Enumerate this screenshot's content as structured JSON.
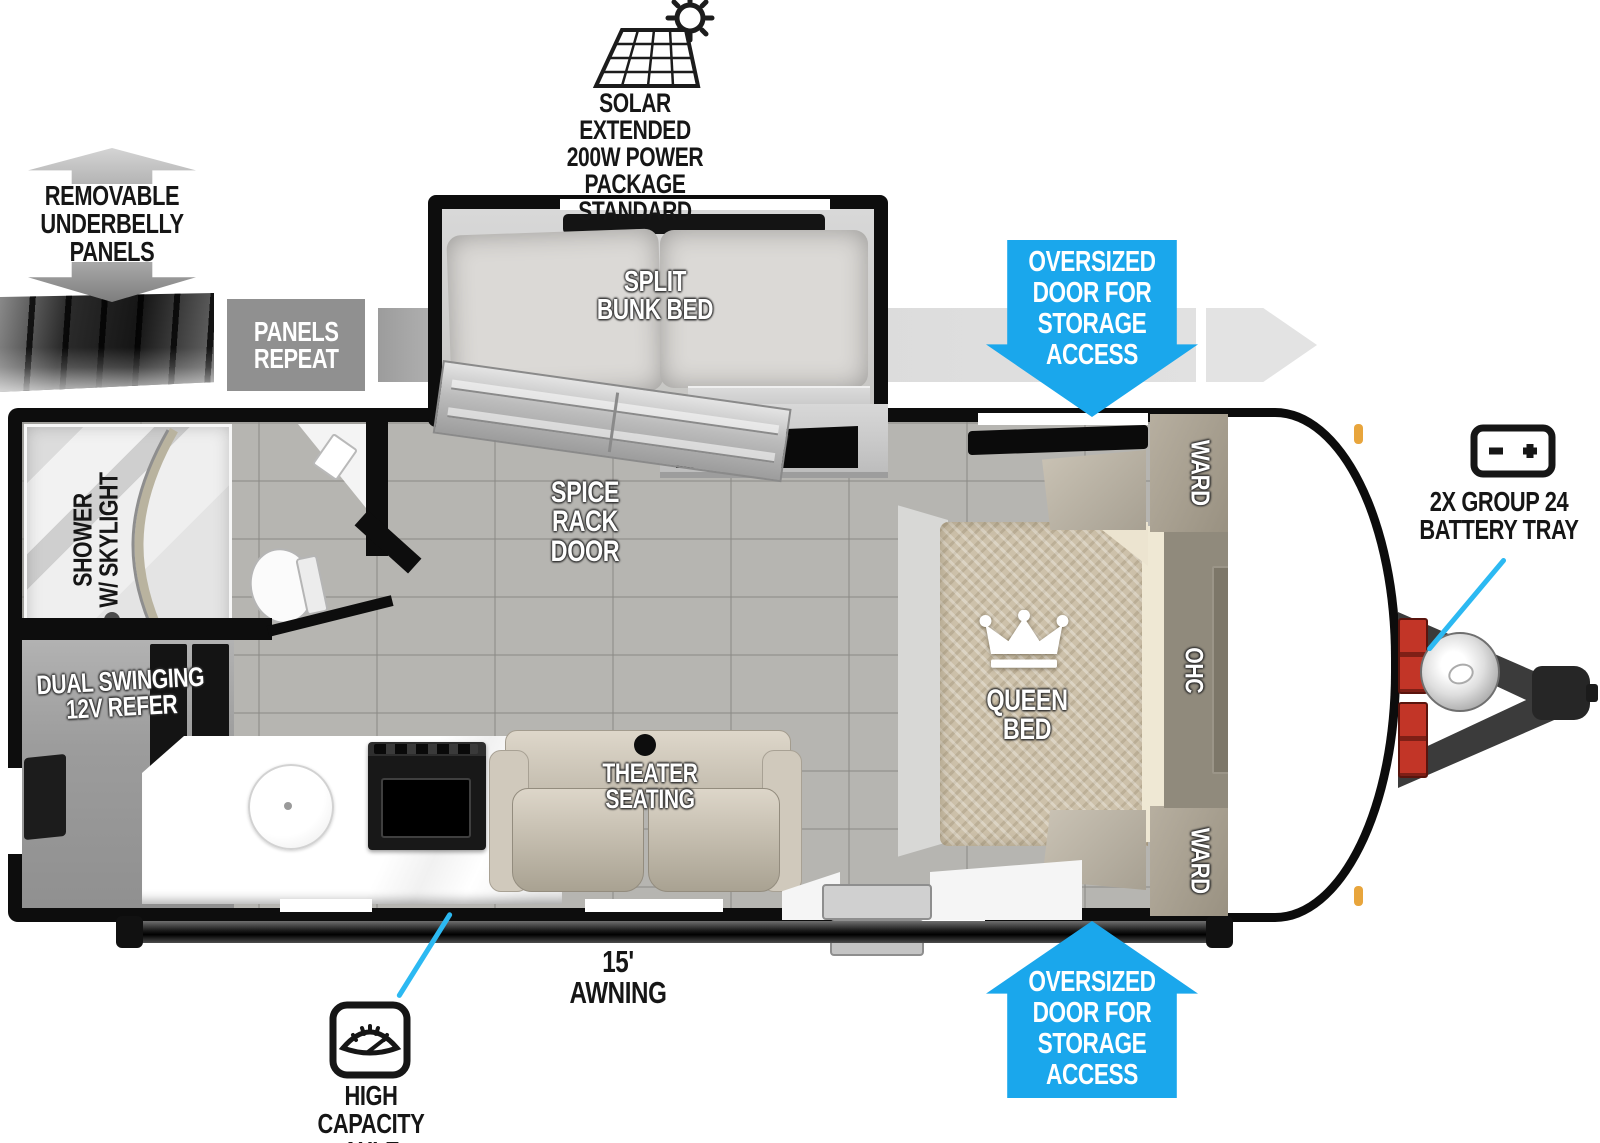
{
  "colors": {
    "accent_blue": "#1aa7ec",
    "callout_cyan": "#2cb9f2",
    "wall_black": "#0d0d0d",
    "band_gray": "#dedede",
    "bed_tan": "#cdc1aa"
  },
  "callouts": {
    "solar": {
      "lines": [
        "SOLAR EXTENDED",
        "200W POWER PACKAGE",
        "STANDARD"
      ]
    },
    "underbelly": {
      "lines": [
        "REMOVABLE",
        "UNDERBELLY",
        "PANELS"
      ]
    },
    "panels_repeat": {
      "lines": [
        "PANELS",
        "REPEAT"
      ]
    },
    "storage_door_top": {
      "lines": [
        "OVERSIZED",
        "DOOR FOR",
        "STORAGE",
        "ACCESS"
      ]
    },
    "storage_door_bottom": {
      "lines": [
        "OVERSIZED",
        "DOOR FOR",
        "STORAGE",
        "ACCESS"
      ]
    },
    "battery": {
      "lines": [
        "2X GROUP 24",
        "BATTERY TRAY"
      ]
    },
    "awning": {
      "label": "15' AWNING"
    },
    "axle": {
      "lines": [
        "HIGH CAPACITY",
        "AXLE"
      ]
    }
  },
  "rooms": {
    "bunk": {
      "lines": [
        "SPLIT",
        "BUNK BED"
      ]
    },
    "spice_rack": {
      "lines": [
        "SPICE RACK",
        "DOOR"
      ]
    },
    "tv": {
      "label": "TV"
    },
    "queen_bed": {
      "label": "QUEEN BED"
    },
    "ward_front_top": {
      "label": "WARD"
    },
    "ward_front_bottom": {
      "label": "WARD"
    },
    "ohc": {
      "label": "OHC"
    },
    "shower": {
      "lines": [
        "SHOWER",
        "W/ SKYLIGHT"
      ]
    },
    "refrigerator": {
      "lines": [
        "DUAL SWINGING",
        "12V REFER"
      ]
    },
    "theater": {
      "lines": [
        "THEATER",
        "SEATING"
      ]
    }
  }
}
